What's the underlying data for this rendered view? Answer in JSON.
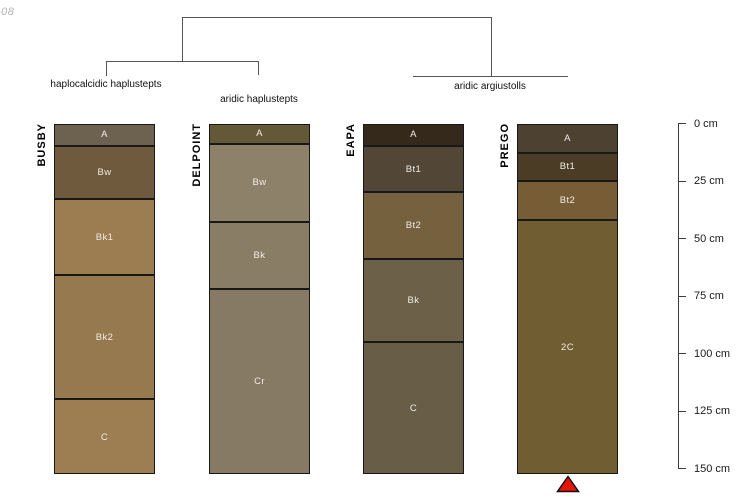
{
  "watermark": "-08",
  "figure_type": "soil-profile comparison with classification dendrogram",
  "tree": {
    "labels": [
      {
        "text": "haplocalcidic haplustepts",
        "profiles": [
          "BUSBY"
        ]
      },
      {
        "text": "aridic haplustepts",
        "profiles": [
          "DELPOINT"
        ]
      },
      {
        "text": "aridic argiustolls",
        "profiles": [
          "EAPA",
          "PREGO"
        ]
      }
    ]
  },
  "profiles": [
    {
      "name": "BUSBY",
      "bottom_cm": 152,
      "horizons": [
        {
          "label": "A",
          "top_cm": 0,
          "bottom_cm": 9,
          "color": "#6d6150"
        },
        {
          "label": "Bw",
          "top_cm": 9,
          "bottom_cm": 32,
          "color": "#6f5a3d"
        },
        {
          "label": "Bk1",
          "top_cm": 32,
          "bottom_cm": 65,
          "color": "#9c7c51"
        },
        {
          "label": "Bk2",
          "top_cm": 65,
          "bottom_cm": 119,
          "color": "#977950"
        },
        {
          "label": "C",
          "top_cm": 119,
          "bottom_cm": 152,
          "color": "#9d7d52"
        }
      ]
    },
    {
      "name": "DELPOINT",
      "bottom_cm": 152,
      "horizons": [
        {
          "label": "A",
          "top_cm": 0,
          "bottom_cm": 8,
          "color": "#645936"
        },
        {
          "label": "Bw",
          "top_cm": 8,
          "bottom_cm": 42,
          "color": "#8e8169"
        },
        {
          "label": "Bk",
          "top_cm": 42,
          "bottom_cm": 71,
          "color": "#8a7d65"
        },
        {
          "label": "Cr",
          "top_cm": 71,
          "bottom_cm": 152,
          "color": "#867a64"
        }
      ]
    },
    {
      "name": "EAPA",
      "bottom_cm": 152,
      "horizons": [
        {
          "label": "A",
          "top_cm": 0,
          "bottom_cm": 9,
          "color": "#35291b"
        },
        {
          "label": "Bt1",
          "top_cm": 9,
          "bottom_cm": 29,
          "color": "#524636"
        },
        {
          "label": "Bt2",
          "top_cm": 29,
          "bottom_cm": 58,
          "color": "#76613f"
        },
        {
          "label": "Bk",
          "top_cm": 58,
          "bottom_cm": 94,
          "color": "#6c6048"
        },
        {
          "label": "C",
          "top_cm": 94,
          "bottom_cm": 152,
          "color": "#685d47"
        }
      ]
    },
    {
      "name": "PREGO",
      "bottom_cm": 152,
      "horizons": [
        {
          "label": "A",
          "top_cm": 0,
          "bottom_cm": 12,
          "color": "#4d4232"
        },
        {
          "label": "Bt1",
          "top_cm": 12,
          "bottom_cm": 24,
          "color": "#4b3c26"
        },
        {
          "label": "Bt2",
          "top_cm": 24,
          "bottom_cm": 41,
          "color": "#765d35"
        },
        {
          "label": "2C",
          "top_cm": 41,
          "bottom_cm": 152,
          "color": "#715d32"
        }
      ]
    }
  ],
  "depth_scale": {
    "unit": "cm",
    "ticks": [
      {
        "depth": 0,
        "label": "0 cm"
      },
      {
        "depth": 25,
        "label": "25 cm"
      },
      {
        "depth": 50,
        "label": "50 cm"
      },
      {
        "depth": 75,
        "label": "75 cm"
      },
      {
        "depth": 100,
        "label": "100 cm"
      },
      {
        "depth": 125,
        "label": "125 cm"
      },
      {
        "depth": 150,
        "label": "150 cm"
      }
    ]
  },
  "marker": {
    "shape": "triangle-up",
    "color": "#e81309",
    "outline": "#111111",
    "under_profile": "PREGO"
  }
}
